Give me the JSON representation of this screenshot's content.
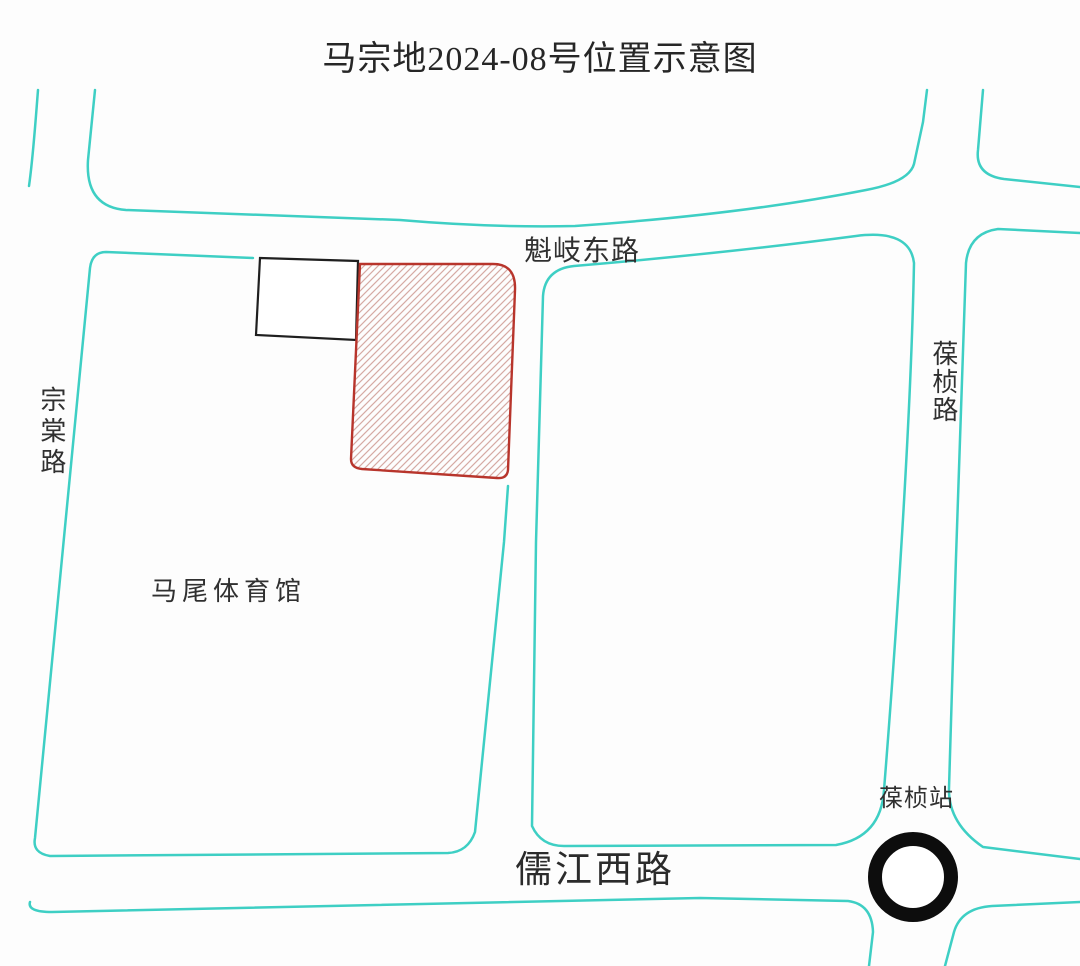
{
  "title": "马宗地2024-08号位置示意图",
  "roads": {
    "kuiqi_east": {
      "label": "魁岐东路",
      "orientation": "horizontal"
    },
    "zongtang": {
      "label": "宗棠路",
      "orientation": "vertical"
    },
    "baozhen": {
      "label": "葆桢路",
      "orientation": "vertical"
    },
    "rujiang_west": {
      "label": "儒江西路",
      "orientation": "horizontal"
    }
  },
  "places": {
    "gymnasium": {
      "label": "马尾体育馆"
    },
    "station": {
      "label": "葆桢站",
      "symbol": "metro-station-ring"
    }
  },
  "parcel": {
    "style": "red outline with diagonal hatching",
    "adjacent_building_style": "black outline rectangle"
  },
  "colors": {
    "road_line": "#3ecfc4",
    "parcel_border": "#b8352c",
    "parcel_hatch": "#d6aaa4",
    "building_outline": "#1f1f1f",
    "station_ring": "#0d0d0d",
    "background": "#fdfdfd",
    "text": "#303030"
  }
}
